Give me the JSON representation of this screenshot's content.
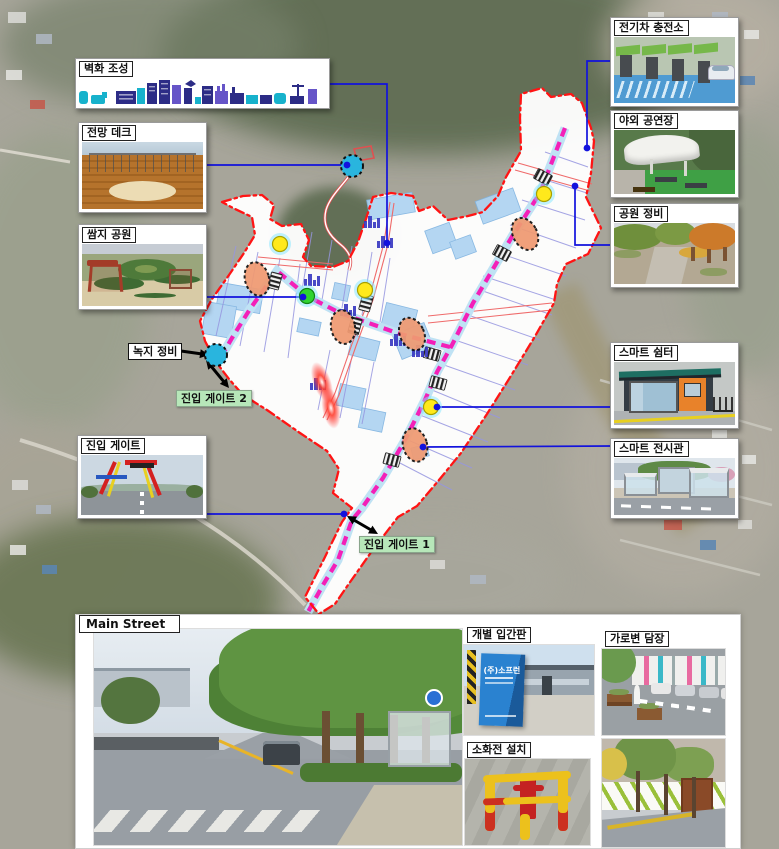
{
  "labels": {
    "mural": "벽화 조성",
    "deck": "전망 데크",
    "pocket_park": "쌈지 공원",
    "green_maint": "녹지 정비",
    "gate2": "진입 게이트 2",
    "gate_photo": "진입 게이트",
    "gate1": "진입 게이트 1",
    "ev_charger": "전기차 충전소",
    "outdoor_stage": "야외 공연장",
    "park_maint": "공원 정비",
    "smart_shelter": "스마트 쉼터",
    "smart_hall": "스마트 전시관",
    "main_street": "Main Street",
    "signboard": "개별 입간판",
    "hydrant": "소화전 설치",
    "street_fence": "가로변 담장",
    "sign_text": "(주)소프런"
  },
  "colors": {
    "boundary": "#ff1414",
    "route": "#f320b8",
    "route_band": "#bfe2f4",
    "parcel_fill": "#aed3f2",
    "connector": "#1212dd",
    "gate_label_bg": "#b7e7b9",
    "orange_marker": "#f09a72",
    "yellow_marker": "#ffe91c",
    "green_marker": "#2fd42f",
    "cyan_marker": "#29b5de"
  },
  "map": {
    "connectors": [
      {
        "name": "mural",
        "points": [
          [
            330,
            84
          ],
          [
            387,
            84
          ],
          [
            387,
            243
          ]
        ]
      },
      {
        "name": "deck",
        "points": [
          [
            203,
            165
          ],
          [
            347,
            165
          ]
        ]
      },
      {
        "name": "pocket-park",
        "points": [
          [
            203,
            297
          ],
          [
            303,
            297
          ]
        ]
      },
      {
        "name": "ev-charger",
        "points": [
          [
            611,
            61
          ],
          [
            587,
            61
          ],
          [
            587,
            148
          ]
        ]
      },
      {
        "name": "park-maint",
        "points": [
          [
            612,
            245
          ],
          [
            575,
            245
          ],
          [
            575,
            186
          ]
        ]
      },
      {
        "name": "smart-shelter",
        "points": [
          [
            612,
            407
          ],
          [
            437,
            407
          ]
        ]
      },
      {
        "name": "smart-hall",
        "points": [
          [
            612,
            446
          ],
          [
            423,
            447
          ]
        ]
      },
      {
        "name": "entry-gate",
        "points": [
          [
            203,
            514
          ],
          [
            344,
            514
          ]
        ]
      }
    ],
    "dots": [
      [
        587,
        148
      ],
      [
        575,
        186
      ],
      [
        387,
        243
      ],
      [
        347,
        165
      ],
      [
        303,
        297
      ],
      [
        437,
        407
      ],
      [
        423,
        447
      ],
      [
        344,
        514
      ]
    ],
    "markers": {
      "yellow": [
        [
          544,
          194
        ],
        [
          280,
          244
        ],
        [
          365,
          290
        ],
        [
          431,
          407
        ]
      ],
      "green": [
        [
          307,
          296
        ]
      ],
      "cyan": [
        [
          352,
          166
        ],
        [
          216,
          355
        ]
      ],
      "orange": [
        [
          525,
          234,
          -28
        ],
        [
          257,
          279,
          -15
        ],
        [
          343,
          327,
          -10
        ],
        [
          412,
          334,
          -25
        ],
        [
          415,
          445,
          -15
        ]
      ],
      "red_glow": [
        [
          322,
          382,
          -20
        ],
        [
          331,
          408,
          -10
        ]
      ],
      "crosswalk": [
        [
          543,
          177,
          28
        ],
        [
          502,
          253,
          28
        ],
        [
          275,
          281,
          105
        ],
        [
          366,
          303,
          105
        ],
        [
          355,
          326,
          105
        ],
        [
          432,
          354,
          15
        ],
        [
          438,
          383,
          15
        ],
        [
          392,
          460,
          15
        ]
      ],
      "skyline": [
        [
          385,
          248
        ],
        [
          312,
          286
        ],
        [
          348,
          316
        ],
        [
          398,
          346
        ],
        [
          318,
          390
        ],
        [
          372,
          228
        ],
        [
          420,
          357
        ]
      ]
    },
    "arrows": [
      {
        "x1": 347,
        "y1": 516,
        "x2": 378,
        "y2": 534,
        "double": true
      },
      {
        "x1": 229,
        "y1": 388,
        "x2": 206,
        "y2": 360,
        "double": true
      },
      {
        "x1": 181,
        "y1": 351,
        "x2": 209,
        "y2": 355,
        "double": false
      }
    ]
  }
}
